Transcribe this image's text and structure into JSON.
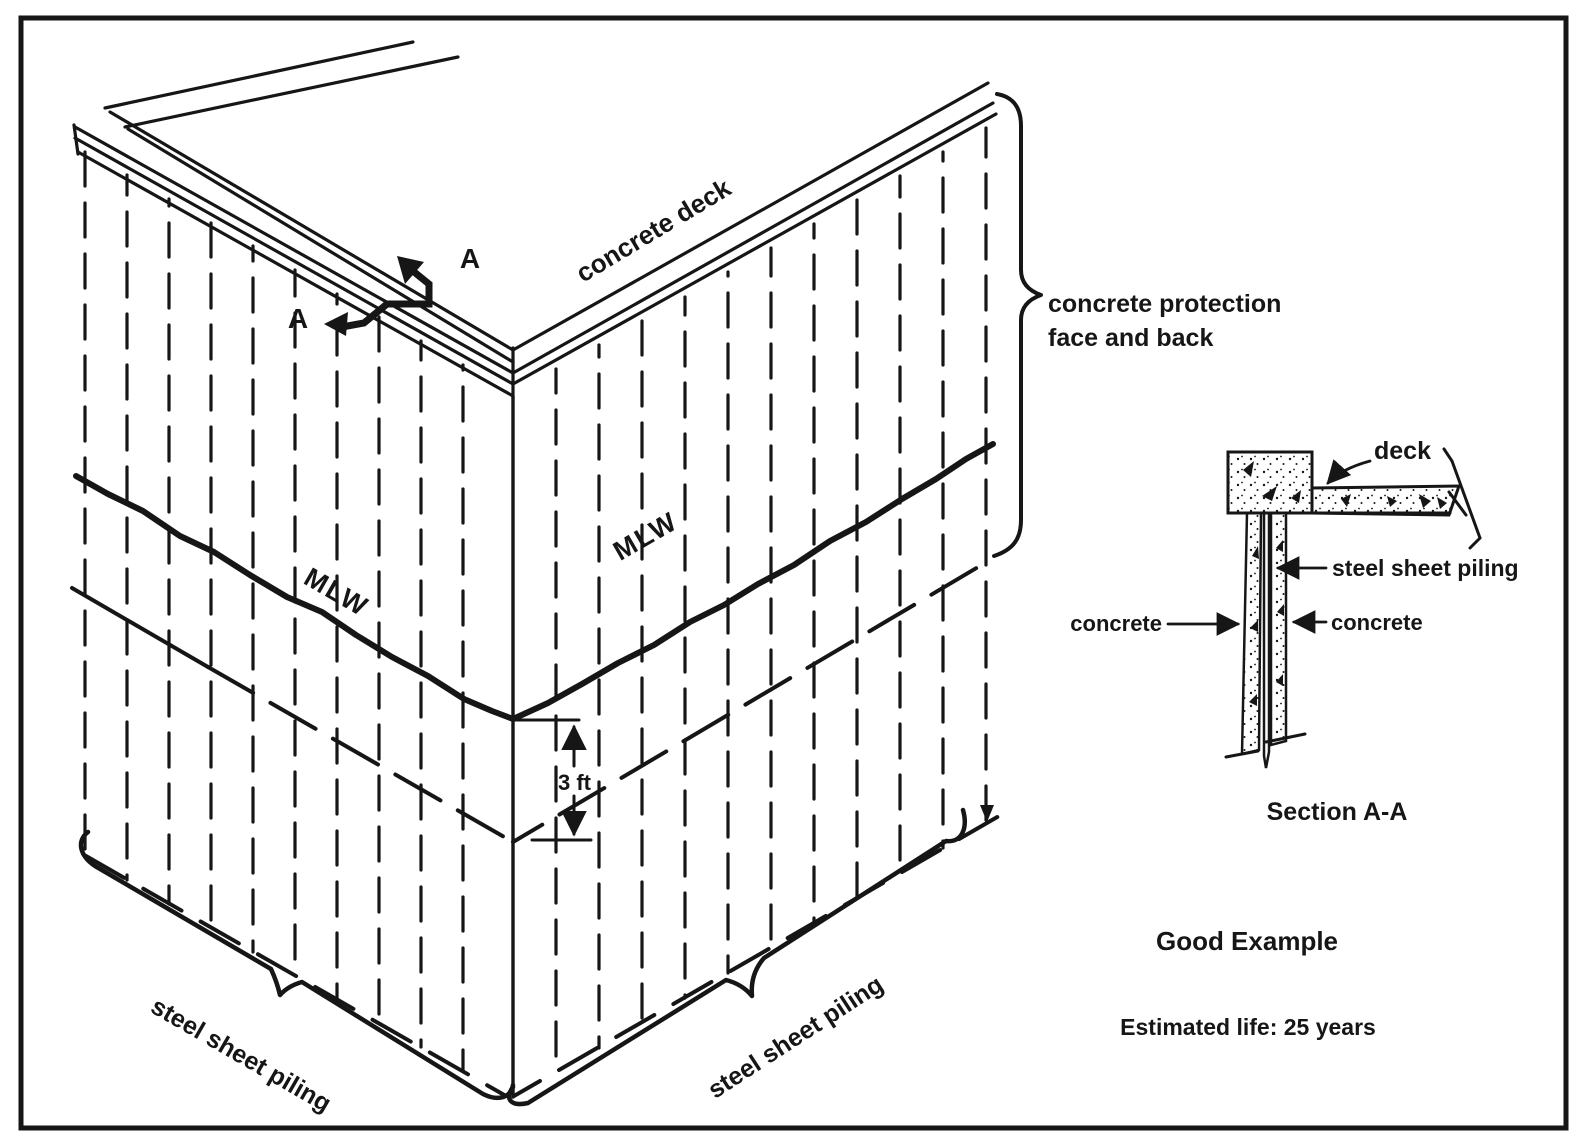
{
  "colors": {
    "ink": "#161616",
    "paper": "#ffffff"
  },
  "perspective": {
    "deck_label": "concrete deck",
    "section_cut": {
      "label_top": "A",
      "label_bottom": "A"
    },
    "water_line": {
      "label_left": "MLW",
      "label_right": "MLW"
    },
    "dimension_3ft": "3 ft",
    "protection_brace": {
      "line1": "concrete protection",
      "line2": "face and back"
    },
    "piling_brace_left": "steel sheet piling",
    "piling_brace_right": "steel sheet piling"
  },
  "section_detail": {
    "deck_label": "deck",
    "piling_label": "steel sheet piling",
    "concrete_label_left": "concrete",
    "concrete_label_right": "concrete",
    "caption": "Section A-A"
  },
  "assessment": {
    "verdict": "Good Example",
    "estimated_life": "Estimated life: 25 years"
  }
}
